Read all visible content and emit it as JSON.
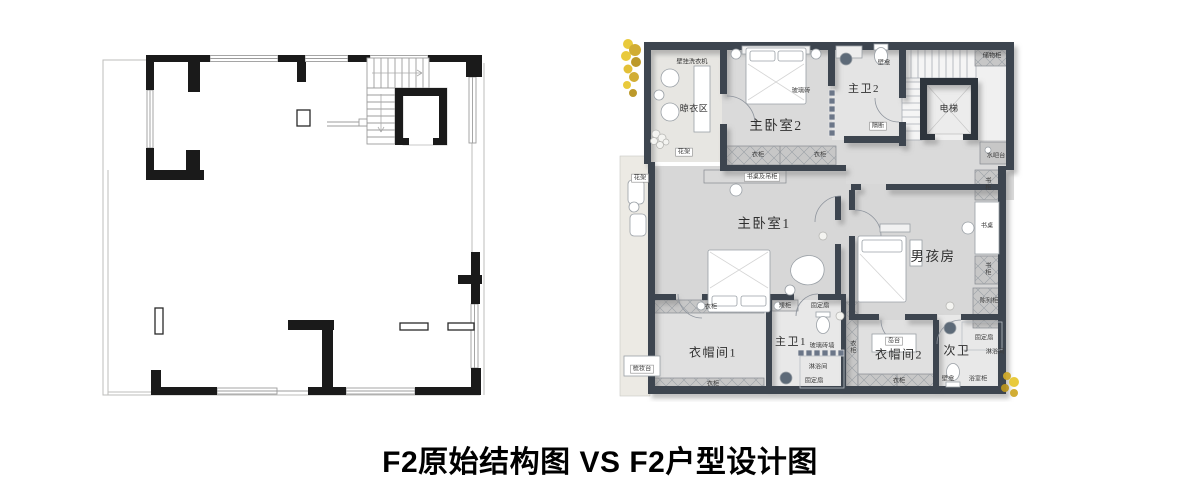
{
  "title": "F2原始结构图 VS F2户型设计图",
  "design_plan": {
    "rooms": {
      "laundry": "晾衣区",
      "master_bedroom2": "主卧室2",
      "master_bath2": "主卫2",
      "elevator": "电梯",
      "master_bedroom1": "主卧室1",
      "boys_room": "男孩房",
      "closet1": "衣帽间1",
      "master_bath1": "主卫1",
      "closet2": "衣帽间2",
      "second_bath": "次卫"
    },
    "tags": {
      "washer": "壁挂洗衣机",
      "glass_brick": "玻璃砖",
      "niche_top": "壁龛",
      "partition": "隔断",
      "storage_cabinet": "储物柜",
      "water_bar": "水吧台",
      "wardrobe_m2_left": "衣柜",
      "wardrobe_m2_right": "衣柜",
      "desk_hanging": "书桌及吊柜",
      "flower_rack_top": "花架",
      "flower_rack_side": "花架",
      "bookcase_top": "书柜",
      "desk": "书桌",
      "bookcase_mid": "书柜",
      "display_cabinet": "陈列柜",
      "wardrobe_c1_top": "衣柜",
      "low_cabinet": "矮柜",
      "fixed_sash_top": "固定扇",
      "glass_brick_wall": "玻璃砖墙",
      "shower1": "淋浴间",
      "fixed_sash_bottom": "固定扇",
      "wardrobe_c1_bottom": "衣柜",
      "dressing_table": "梳妆台",
      "wardrobe_mid_strip": "衣柜",
      "island": "岛台",
      "wardrobe_c2": "衣柜",
      "fixed_sash_bath2": "固定扇",
      "shower2": "淋浴间",
      "niche_bath2": "壁龛",
      "vanity_bath2": "浴室柜"
    },
    "colors": {
      "wall": "#3d4450",
      "floor": "#dadada",
      "balcony_floor": "#eceae4",
      "accent_plant": "#e8c832",
      "structure_wall": "#1a1a1a"
    }
  }
}
